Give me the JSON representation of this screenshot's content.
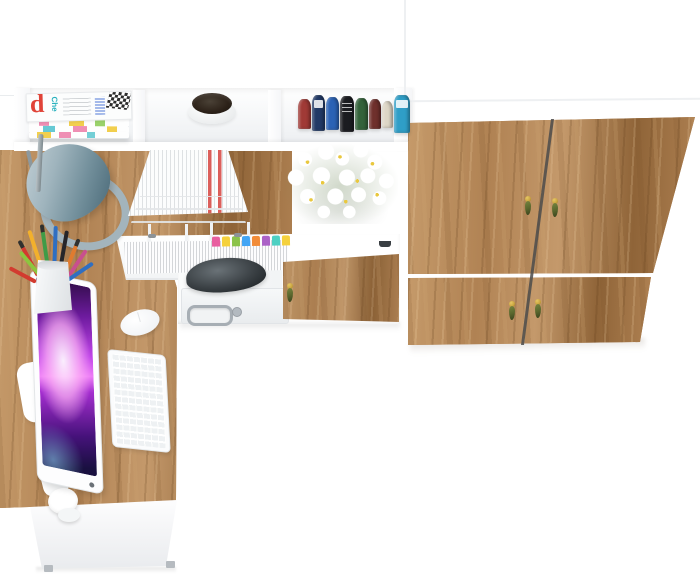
{
  "scene": {
    "title": "L-shaped corner desk with hutch shelving and oak-door wardrobe, viewed from above",
    "background_color": "#ffffff",
    "furniture": {
      "desk": "L-shaped desk, white carcass with oak worktop",
      "hutch": "white open-cubby shelf hutch above the desk return",
      "wardrobe": "tall wardrobe with four oak doors and olive drop handles",
      "drawer": "oak-front drawer with olive drop handle",
      "pullout_shelf": "white pull-out shelf holding a paper stack with index tabs"
    },
    "props": [
      "magazine-stack",
      "potted-plant",
      "book-row",
      "desk-lamp",
      "wire-document-tray",
      "daisy-bouquet",
      "paper-stack-with-tabs",
      "printer",
      "monitor",
      "keyboard",
      "mouse",
      "pencil-cup"
    ]
  },
  "magazine": {
    "cover_letter": "d",
    "cover_word": "Che"
  },
  "colors": {
    "wood-light": "#c59a6a",
    "wood-mid": "#b08253",
    "wood-dark": "#8f6438",
    "handle-brass": "#c9a43e",
    "handle-olive": "#5b682e",
    "lamp-light": "#c4d1d7",
    "lamp-mid": "#9fb4bd",
    "lamp-dark": "#51707e",
    "screen-dark": "#2a0b3f",
    "screen-magenta": "#a42ecf",
    "screen-pink": "#ee7cf7",
    "screen-navy": "#191040",
    "printer-dark": "#3a4044",
    "metal": "#a7aeb4",
    "plant-pot": "#2c2118",
    "flower-center": "#e9c83f",
    "flower-green": "#6a8455",
    "mag-red": "#e04338",
    "mag-teal": "#27b0bd",
    "mag-blue": "#2f5fd0",
    "book-1": "#a03a36",
    "book-2": "#223a66",
    "book-3": "#2b62b5",
    "book-4": "#1b1c20",
    "book-5": "#33623a",
    "book-6": "#6f302c",
    "book-7": "#ddd6c6",
    "book-8": "#2f9ec7",
    "pencil-1": "#d23b2f",
    "pencil-2": "#f2b02c",
    "pencil-3": "#3f9b47",
    "pencil-4": "#2f6fc2",
    "pencil-5": "#26262a",
    "pencil-6": "#e07b2f",
    "pencil-7": "#c94f8e",
    "pencil-8": "#8cc63f",
    "tab-1": "#e85fa0",
    "tab-2": "#f5d13c",
    "tab-3": "#8bc34a",
    "tab-4": "#42a5f5",
    "tab-5": "#f28c38",
    "tab-6": "#ab62c7",
    "tab-7": "#4dd0c2",
    "tab-8": "#f5d13c"
  }
}
